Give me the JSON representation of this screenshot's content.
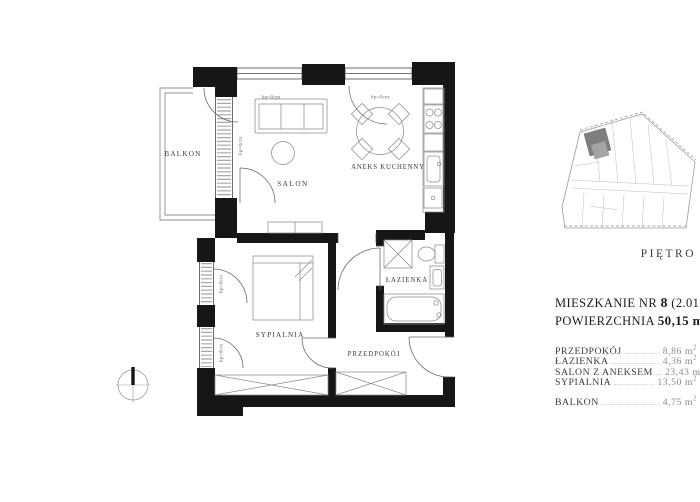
{
  "plan": {
    "room_labels": {
      "balkon": "BALKON",
      "salon": "SALON",
      "aneks_kuchenny": "ANEKS KUCHENNY",
      "lazienka": "ŁAZIENKA",
      "sypialnia": "SYPIALNIA",
      "przedpokoj": "PRZEDPOKÓJ"
    },
    "window_sill_labels": {
      "top_window_1": "hp=0cm",
      "top_window_2": "hp=0cm",
      "balcony_door": "hp=0cm",
      "bedroom_window_1": "hp=0cm",
      "bedroom_window_2": "hp=0cm"
    }
  },
  "key_plan": {
    "caption": "PIĘTRO"
  },
  "info_panel": {
    "title": {
      "prefix": "MIESZKANIE NR",
      "number": "8",
      "suffix": "(2.01)"
    },
    "area": {
      "label": "POWIERZCHNIA",
      "value": "50,15",
      "unit": "m",
      "unit_sup": "2)"
    },
    "rooms": [
      {
        "name": "PRZEDPOKÓJ",
        "area": "8,86"
      },
      {
        "name": "ŁAZIENKA",
        "area": "4,36"
      },
      {
        "name": "SALON Z ANEKSEM",
        "area": "23,43"
      },
      {
        "name": "SYPIALNIA",
        "area": "13,50"
      }
    ],
    "balcony": {
      "name": "BALKON",
      "area": "4,75"
    },
    "unit": "m",
    "unit_sup": "2"
  },
  "colors": {
    "wall": "#161616",
    "thin_line": "#4a4a4a",
    "door_line": "#6b6b6b",
    "furniture_line": "#8c8c8c",
    "hatch": "#a8a8a8",
    "text": "#3a3a3a",
    "muted_text": "#8b8b8b",
    "key_highlight": "#7f7f7f"
  }
}
